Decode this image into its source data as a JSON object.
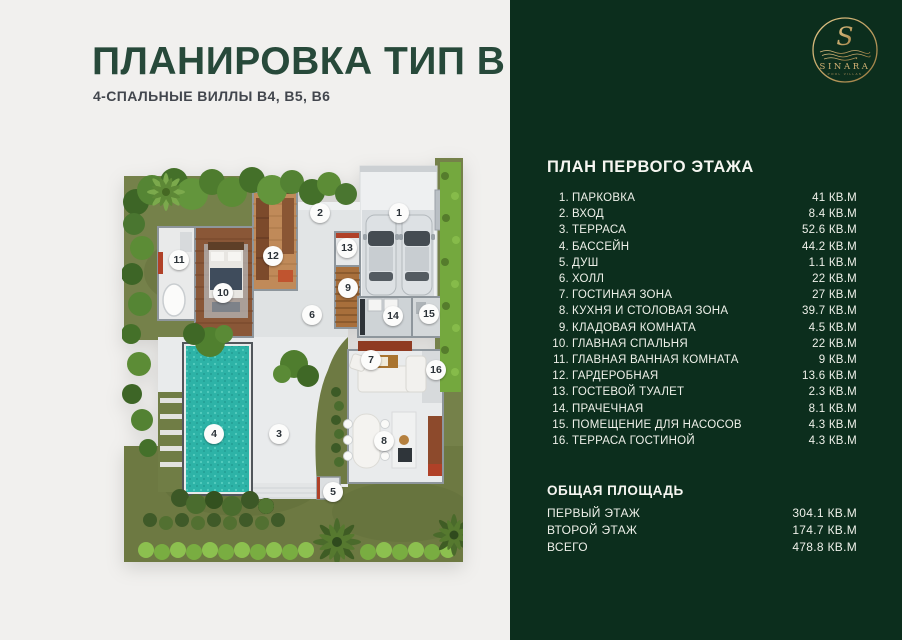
{
  "colors": {
    "page_bg": "#f1f0ee",
    "panel_bg": "#0c2e1d",
    "title_green": "#27493a",
    "gold": "#c7a566",
    "pool_teal": "#2db3a7"
  },
  "header": {
    "title": "ПЛАНИРОВКА ТИП В",
    "subtitle": "4-СПАЛЬНЫЕ ВИЛЛЫ B4, B5, B6"
  },
  "logo": {
    "monogram": "S",
    "brand": "SINARA",
    "tagline": "POOL VILLAS"
  },
  "panel": {
    "heading": "ПЛАН ПЕРВОГО ЭТАЖА",
    "rooms": [
      {
        "num": "1.",
        "label": "ПАРКОВКА",
        "area": "41 КВ.М"
      },
      {
        "num": "2.",
        "label": "ВХОД",
        "area": "8.4 КВ.М"
      },
      {
        "num": "3.",
        "label": "ТЕРРАСА",
        "area": "52.6 КВ.М"
      },
      {
        "num": "4.",
        "label": "БАССЕЙН",
        "area": "44.2 КВ.М"
      },
      {
        "num": "5.",
        "label": "ДУШ",
        "area": "1.1 КВ.М"
      },
      {
        "num": "6.",
        "label": "ХОЛЛ",
        "area": "22 КВ.М"
      },
      {
        "num": "7.",
        "label": "ГОСТИНАЯ ЗОНА",
        "area": "27 КВ.М"
      },
      {
        "num": "8.",
        "label": "КУХНЯ И СТОЛОВАЯ ЗОНА",
        "area": "39.7 КВ.М"
      },
      {
        "num": "9.",
        "label": "КЛАДОВАЯ КОМНАТА",
        "area": "4.5 КВ.М"
      },
      {
        "num": "10.",
        "label": "ГЛАВНАЯ СПАЛЬНЯ",
        "area": "22 КВ.М"
      },
      {
        "num": "11.",
        "label": "ГЛАВНАЯ ВАННАЯ КОМНАТА",
        "area": "9 КВ.М"
      },
      {
        "num": "12.",
        "label": "ГАРДЕРОБНАЯ",
        "area": "13.6 КВ.М"
      },
      {
        "num": "13.",
        "label": "ГОСТЕВОЙ ТУАЛЕТ",
        "area": "2.3 КВ.М"
      },
      {
        "num": "14.",
        "label": "ПРАЧЕЧНАЯ",
        "area": "8.1 КВ.М"
      },
      {
        "num": "15.",
        "label": "ПОМЕЩЕНИЕ ДЛЯ НАСОСОВ",
        "area": "4.3 КВ.М"
      },
      {
        "num": "16.",
        "label": "ТЕРРАСА ГОСТИНОЙ",
        "area": "4.3 КВ.М"
      }
    ],
    "totals_heading": "ОБЩАЯ ПЛОЩАДЬ",
    "totals": [
      {
        "label": "ПЕРВЫЙ ЭТАЖ",
        "area": "304.1 КВ.М"
      },
      {
        "label": "ВТОРОЙ ЭТАЖ",
        "area": "174.7 КВ.М"
      },
      {
        "label": "ВСЕГО",
        "area": "478.8 КВ.М"
      }
    ]
  },
  "floorplan": {
    "w": 341,
    "h": 410,
    "markers": [
      {
        "n": "1",
        "x": 277,
        "y": 61
      },
      {
        "n": "2",
        "x": 198,
        "y": 61
      },
      {
        "n": "3",
        "x": 157,
        "y": 282
      },
      {
        "n": "4",
        "x": 92,
        "y": 282
      },
      {
        "n": "5",
        "x": 211,
        "y": 340
      },
      {
        "n": "6",
        "x": 190,
        "y": 163
      },
      {
        "n": "7",
        "x": 249,
        "y": 208
      },
      {
        "n": "8",
        "x": 262,
        "y": 289
      },
      {
        "n": "9",
        "x": 226,
        "y": 136
      },
      {
        "n": "10",
        "x": 101,
        "y": 141
      },
      {
        "n": "11",
        "x": 57,
        "y": 108
      },
      {
        "n": "12",
        "x": 151,
        "y": 104
      },
      {
        "n": "13",
        "x": 225,
        "y": 96
      },
      {
        "n": "14",
        "x": 271,
        "y": 164
      },
      {
        "n": "15",
        "x": 307,
        "y": 162
      },
      {
        "n": "16",
        "x": 314,
        "y": 218
      }
    ]
  }
}
